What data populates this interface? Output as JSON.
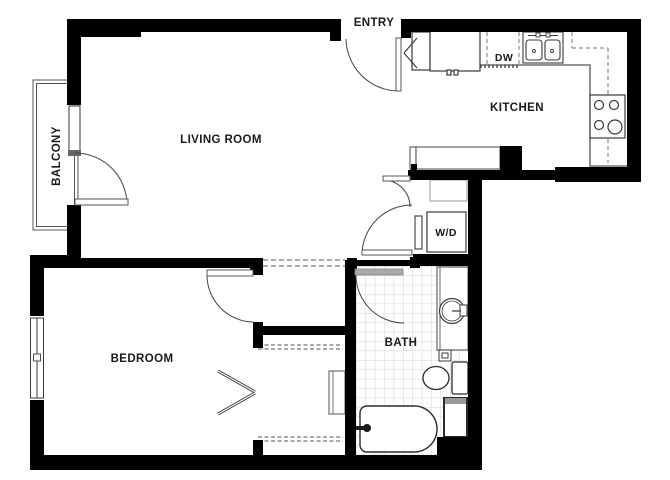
{
  "floorplan": {
    "type": "apartment-floor-plan",
    "labels": {
      "entry": "ENTRY",
      "living_room": "LIVING ROOM",
      "kitchen": "KITCHEN",
      "balcony": "BALCONY",
      "bedroom": "BEDROOM",
      "bath": "BATH",
      "washer_dryer": "W/D",
      "dishwasher": "DW"
    },
    "colors": {
      "wall": "#000000",
      "fixture_line": "#3a3a3a",
      "counter_line": "#555555",
      "door_leaf_gray": "#a9a9a9",
      "tile_grid": "#c9c9c9",
      "dashed_line": "#777777",
      "background": "#ffffff",
      "label_text": "#1a1a1a"
    }
  }
}
